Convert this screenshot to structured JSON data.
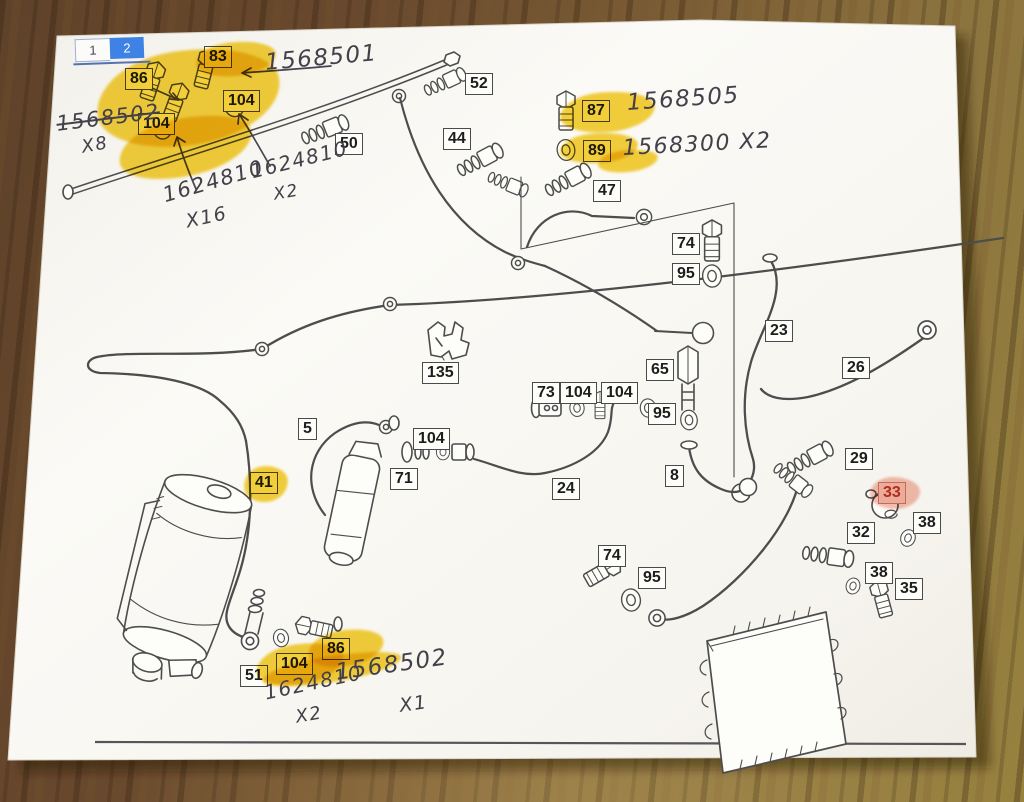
{
  "scene": {
    "description": "Photo of a printed Mercedes parts diagram page lying on a wooden desk",
    "colors": {
      "paper": "#f9f8f4",
      "print_line": "#4d4d4d",
      "highlighter_yellow": "#f2c50b",
      "highlighter_pink": "#f0a896",
      "ink": "#434049",
      "tab_active_blue": "#3d82e4",
      "red_label": "#b93b2a",
      "wood_dark": "#5e4229",
      "wood_light": "#97823f"
    }
  },
  "tabs": [
    {
      "label": "1",
      "active": false
    },
    {
      "label": "2",
      "active": true
    }
  ],
  "part_labels": [
    {
      "text": "83",
      "x": 204,
      "y": 46
    },
    {
      "text": "86",
      "x": 125,
      "y": 68
    },
    {
      "text": "104",
      "x": 223,
      "y": 90
    },
    {
      "text": "104",
      "x": 138,
      "y": 113
    },
    {
      "text": "52",
      "x": 465,
      "y": 73
    },
    {
      "text": "50",
      "x": 335,
      "y": 133
    },
    {
      "text": "44",
      "x": 443,
      "y": 128
    },
    {
      "text": "87",
      "x": 582,
      "y": 100
    },
    {
      "text": "89",
      "x": 583,
      "y": 140
    },
    {
      "text": "47",
      "x": 593,
      "y": 180
    },
    {
      "text": "74",
      "x": 672,
      "y": 233
    },
    {
      "text": "95",
      "x": 672,
      "y": 263
    },
    {
      "text": "23",
      "x": 765,
      "y": 320
    },
    {
      "text": "26",
      "x": 842,
      "y": 357
    },
    {
      "text": "65",
      "x": 646,
      "y": 359
    },
    {
      "text": "95",
      "x": 648,
      "y": 403
    },
    {
      "text": "135",
      "x": 422,
      "y": 362
    },
    {
      "text": "73",
      "x": 532,
      "y": 382
    },
    {
      "text": "104",
      "x": 560,
      "y": 382
    },
    {
      "text": "104",
      "x": 601,
      "y": 382
    },
    {
      "text": "104",
      "x": 413,
      "y": 428
    },
    {
      "text": "71",
      "x": 390,
      "y": 468
    },
    {
      "text": "24",
      "x": 552,
      "y": 478
    },
    {
      "text": "8",
      "x": 665,
      "y": 465
    },
    {
      "text": "5",
      "x": 298,
      "y": 418
    },
    {
      "text": "41",
      "x": 250,
      "y": 472
    },
    {
      "text": "29",
      "x": 845,
      "y": 448
    },
    {
      "text": "33",
      "x": 878,
      "y": 482,
      "cls": "red"
    },
    {
      "text": "38",
      "x": 913,
      "y": 512
    },
    {
      "text": "32",
      "x": 847,
      "y": 522
    },
    {
      "text": "38",
      "x": 865,
      "y": 562
    },
    {
      "text": "35",
      "x": 895,
      "y": 578
    },
    {
      "text": "74",
      "x": 598,
      "y": 545
    },
    {
      "text": "95",
      "x": 638,
      "y": 567
    },
    {
      "text": "51",
      "x": 240,
      "y": 665
    },
    {
      "text": "104",
      "x": 276,
      "y": 653
    },
    {
      "text": "86",
      "x": 322,
      "y": 638
    }
  ],
  "annotations": [
    {
      "text": "1568501",
      "x": 264,
      "y": 50,
      "rot": -5,
      "size": 23
    },
    {
      "text": "1568502",
      "x": 55,
      "y": 112,
      "rot": -7,
      "size": 21,
      "cls": "strike"
    },
    {
      "text": "X8",
      "x": 80,
      "y": 137,
      "rot": -10,
      "size": 18
    },
    {
      "text": "1624810",
      "x": 160,
      "y": 184,
      "rot": -16,
      "size": 21
    },
    {
      "text": "X16",
      "x": 184,
      "y": 211,
      "rot": -12,
      "size": 19
    },
    {
      "text": "1624810",
      "x": 248,
      "y": 160,
      "rot": -14,
      "size": 20
    },
    {
      "text": "X2",
      "x": 272,
      "y": 185,
      "rot": -10,
      "size": 17
    },
    {
      "text": "1568505",
      "x": 626,
      "y": 90,
      "rot": -4,
      "size": 23
    },
    {
      "text": "1568300  X2",
      "x": 622,
      "y": 136,
      "rot": -3,
      "size": 22
    },
    {
      "text": "1624810",
      "x": 262,
      "y": 681,
      "rot": -12,
      "size": 20
    },
    {
      "text": "X2",
      "x": 294,
      "y": 707,
      "rot": -10,
      "size": 18
    },
    {
      "text": "1568502",
      "x": 334,
      "y": 660,
      "rot": -8,
      "size": 23
    },
    {
      "text": "X1",
      "x": 398,
      "y": 695,
      "rot": -8,
      "size": 19
    }
  ],
  "highlights": [
    {
      "x": 96,
      "y": 50,
      "w": 185,
      "h": 95,
      "rot": -9
    },
    {
      "x": 118,
      "y": 118,
      "w": 135,
      "h": 58,
      "rot": -12
    },
    {
      "x": 196,
      "y": 42,
      "w": 80,
      "h": 34,
      "rot": -6
    },
    {
      "x": 560,
      "y": 92,
      "w": 95,
      "h": 40,
      "rot": -5
    },
    {
      "x": 560,
      "y": 133,
      "w": 78,
      "h": 30,
      "rot": -4
    },
    {
      "x": 598,
      "y": 150,
      "w": 60,
      "h": 22,
      "rot": -6
    },
    {
      "x": 244,
      "y": 466,
      "w": 44,
      "h": 36,
      "rot": -8
    },
    {
      "x": 256,
      "y": 644,
      "w": 88,
      "h": 40,
      "rot": -9
    },
    {
      "x": 308,
      "y": 630,
      "w": 76,
      "h": 36,
      "rot": -9
    },
    {
      "x": 262,
      "y": 656,
      "w": 140,
      "h": 26,
      "rot": -9
    },
    {
      "x": 870,
      "y": 477,
      "w": 50,
      "h": 32,
      "rot": 0,
      "cls": "pink"
    }
  ]
}
